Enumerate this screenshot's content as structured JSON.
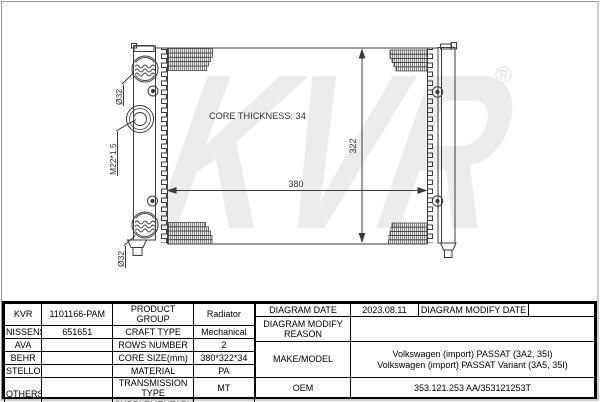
{
  "diagram": {
    "watermark_text": "KVR",
    "registered_symbol": "®",
    "core_thickness": "CORE THICKNESS: 34",
    "width_dim": "380",
    "height_dim": "322",
    "inlet_label": "Ø32",
    "outlet_label": "Ø32",
    "thread_label": "M22*1.5"
  },
  "table": {
    "brand_rows": [
      {
        "brand": "KVR",
        "part_number": "1101166-PAM"
      },
      {
        "brand": "NISSENS",
        "part_number": "651651"
      },
      {
        "brand": "AVA",
        "part_number": ""
      },
      {
        "brand": "BEHR",
        "part_number": ""
      },
      {
        "brand": "STELLOX",
        "part_number": ""
      },
      {
        "brand": "OTHERS",
        "part_number": ""
      }
    ],
    "spec_rows": [
      {
        "label": "PRODUCT GROUP",
        "value": "Radiator"
      },
      {
        "label": "CRAFT TYPE",
        "value": "Mechanical"
      },
      {
        "label": "ROWS NUMBER",
        "value": "2"
      },
      {
        "label": "CORE SIZE(mm)",
        "value": "380*322*34"
      },
      {
        "label": "MATERIAL",
        "value": "PA"
      },
      {
        "label": "TRANSMISSION TYPE",
        "value": "MT"
      },
      {
        "label": "SUPPLEMENTARY",
        "value": ""
      }
    ],
    "right": {
      "diagram_date_label": "DIAGRAM DATE",
      "diagram_date_value": "2023.08.11",
      "diagram_modify_date_label": "DIAGRAM MODIFY DATE",
      "diagram_modify_date_value": "",
      "diagram_modify_reason_label": "DIAGRAM MODIFY REASON",
      "diagram_modify_reason_value": "",
      "make_model_label": "MAKE/MODEL",
      "make_model_line1": "Volkswagen (import) PASSAT (3A2, 35I)",
      "make_model_line2": "Volkswagen (import) PASSAT Variant (3A5, 35I)",
      "oem_label": "OEM",
      "oem_value": "353.121.253 AA/353121253T"
    }
  }
}
